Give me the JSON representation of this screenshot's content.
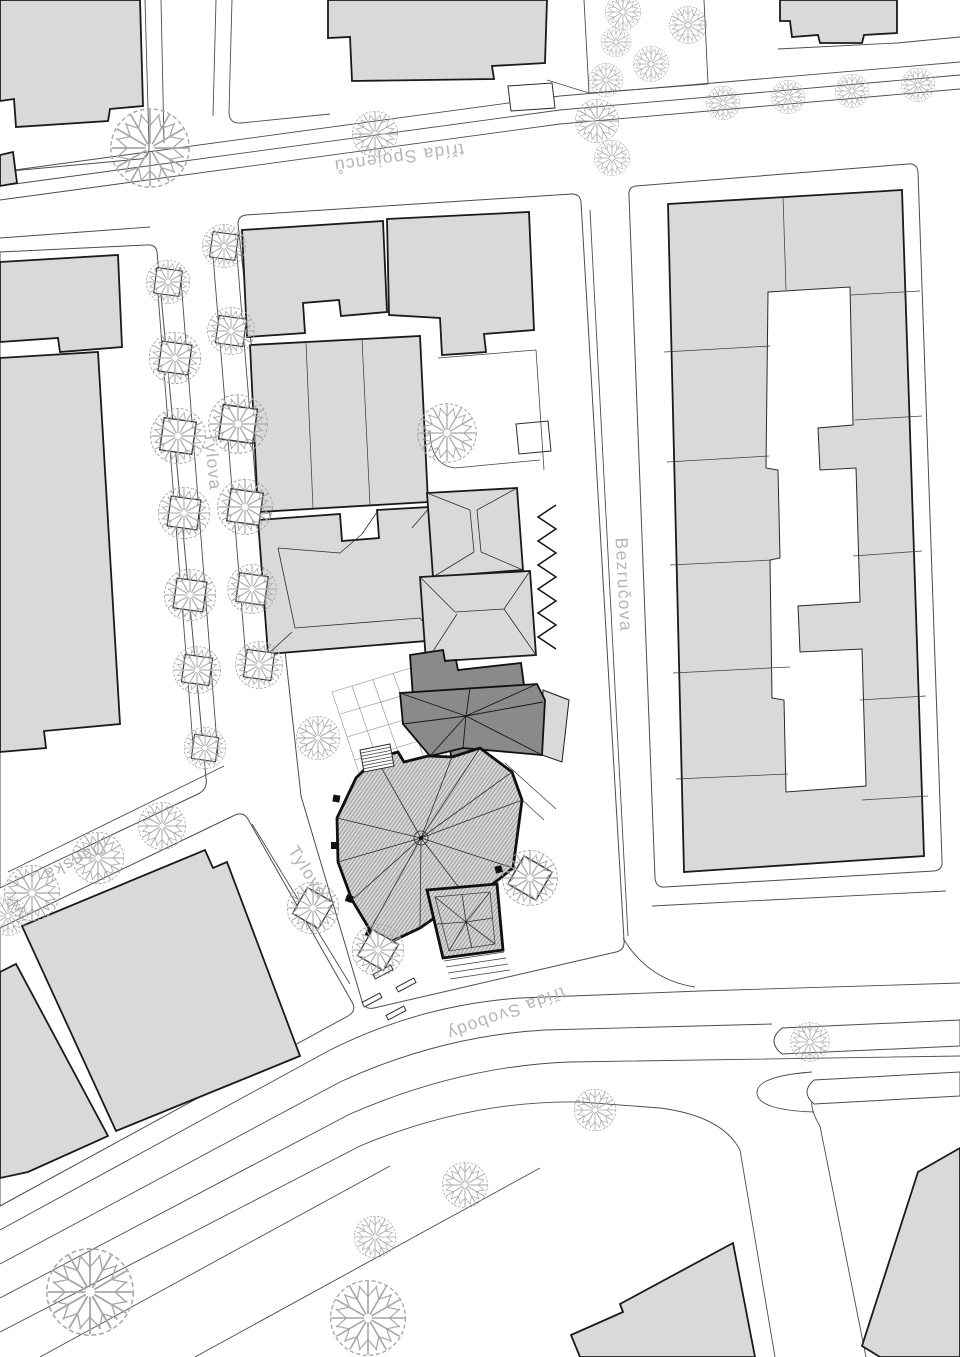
{
  "streets": {
    "spojencu": "třída Spojenců",
    "tylova_north": "Tylova",
    "tylova_south": "Tylova",
    "bezrucova": "Bezručova",
    "danska": "Dánská",
    "svobody": "třída Svobody"
  },
  "colors": {
    "background": "#ffffff",
    "building_fill": "#d9d9d9",
    "building_outline": "#1a1a1a",
    "highlight_fill": "#8a8a8a",
    "road_line": "#4c4c4c",
    "tree_stroke": "#a6a6a6",
    "label_color": "#b5b5b5",
    "church_hatch": "#858585"
  }
}
